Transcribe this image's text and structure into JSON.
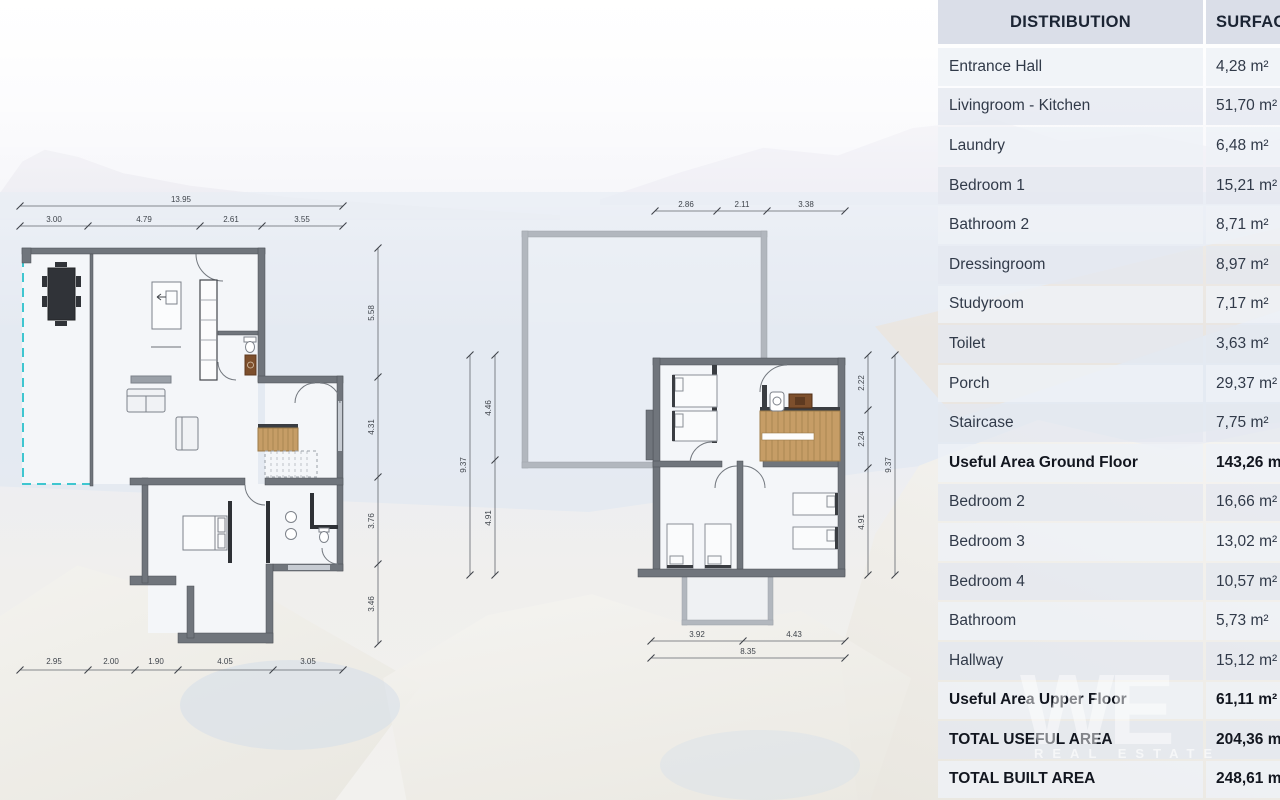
{
  "table": {
    "header": {
      "distribution": "DISTRIBUTION",
      "surface": "SURFACE"
    },
    "rows": [
      {
        "label": "Entrance Hall",
        "value": "4,28 m²",
        "emphasis": false
      },
      {
        "label": "Livingroom - Kitchen",
        "value": "51,70 m²",
        "emphasis": false
      },
      {
        "label": "Laundry",
        "value": "6,48 m²",
        "emphasis": false
      },
      {
        "label": "Bedroom 1",
        "value": "15,21 m²",
        "emphasis": false
      },
      {
        "label": "Bathroom 2",
        "value": "8,71 m²",
        "emphasis": false
      },
      {
        "label": "Dressingroom",
        "value": "8,97 m²",
        "emphasis": false
      },
      {
        "label": "Studyroom",
        "value": "7,17 m²",
        "emphasis": false
      },
      {
        "label": "Toilet",
        "value": "3,63 m²",
        "emphasis": false
      },
      {
        "label": "Porch",
        "value": "29,37 m²",
        "emphasis": false
      },
      {
        "label": "Staircase",
        "value": "7,75 m²",
        "emphasis": false
      },
      {
        "label": "Useful Area Ground Floor",
        "value": "143,26 m²",
        "emphasis": true
      },
      {
        "label": "Bedroom 2",
        "value": "16,66 m²",
        "emphasis": false
      },
      {
        "label": "Bedroom 3",
        "value": "13,02 m²",
        "emphasis": false
      },
      {
        "label": "Bedroom 4",
        "value": "10,57 m²",
        "emphasis": false
      },
      {
        "label": "Bathroom",
        "value": "5,73 m²",
        "emphasis": false
      },
      {
        "label": "Hallway",
        "value": "15,12 m²",
        "emphasis": false
      },
      {
        "label": "Useful Area Upper Floor",
        "value": "61,11 m²",
        "emphasis": true
      },
      {
        "label": "TOTAL USEFUL AREA",
        "value": "204,36 m²",
        "emphasis": true
      },
      {
        "label": "TOTAL BUILT AREA",
        "value": "248,61 m²",
        "emphasis": true
      }
    ]
  },
  "ground_floor": {
    "dims": {
      "top_total": "13.95",
      "top_segments": [
        "3.00",
        "4.79",
        "2.61",
        "3.55"
      ],
      "right_segments": [
        "5.58",
        "4.31",
        "3.76",
        "3.46"
      ],
      "bottom_segments": [
        "2.95",
        "2.00",
        "1.90",
        "4.05",
        "3.05"
      ]
    }
  },
  "upper_floor": {
    "dims": {
      "top_segments": [
        "2.86",
        "2.11",
        "3.38"
      ],
      "left_total": "9.37",
      "left_segments": [
        "4.46",
        "4.91"
      ],
      "right_segments": [
        "2.22",
        "2.24",
        "4.91"
      ],
      "right_total": "9.37",
      "bottom_segments": [
        "3.92",
        "4.43"
      ],
      "bottom_total": "8.35"
    }
  },
  "watermark": {
    "logo": "WE",
    "subtext": "REAL ESTATE"
  },
  "colors": {
    "accent_porch_dashed": "#3fc6d0",
    "wall": "#70757c",
    "wood": "#c69d66"
  }
}
